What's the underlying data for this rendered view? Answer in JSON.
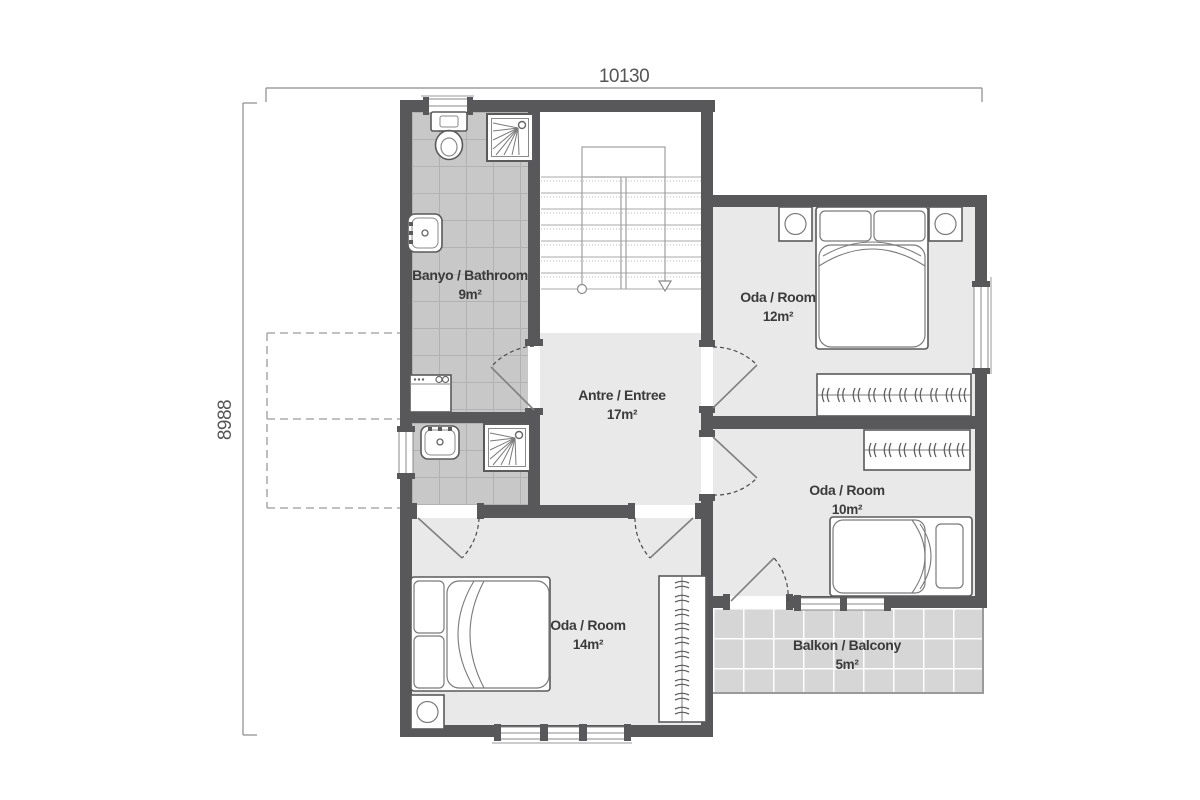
{
  "plan_title": "First floor plan",
  "dimensions": {
    "width_label": "10130",
    "height_label": "8988"
  },
  "rooms": {
    "bathroom": {
      "name": "Banyo / Bathroom",
      "area": "9m²"
    },
    "entree": {
      "name": "Antre / Entree",
      "area": "17m²"
    },
    "bedroom12": {
      "name": "Oda / Room",
      "area": "12m²"
    },
    "bedroom10": {
      "name": "Oda / Room",
      "area": "10m²"
    },
    "bedroom14": {
      "name": "Oda / Room",
      "area": "14m²"
    },
    "balcony": {
      "name": "Balkon / Balcony",
      "area": "5m²"
    }
  },
  "colors": {
    "wall": "#58585a",
    "room_floor": "#e9e9e9",
    "bath_tile": "#c8c8c8",
    "balcony_tile": "#d6d6d6",
    "furniture_line": "#5f5f5f",
    "dimension_line": "#8a8a8a",
    "label_text": "#3b3b3b"
  }
}
